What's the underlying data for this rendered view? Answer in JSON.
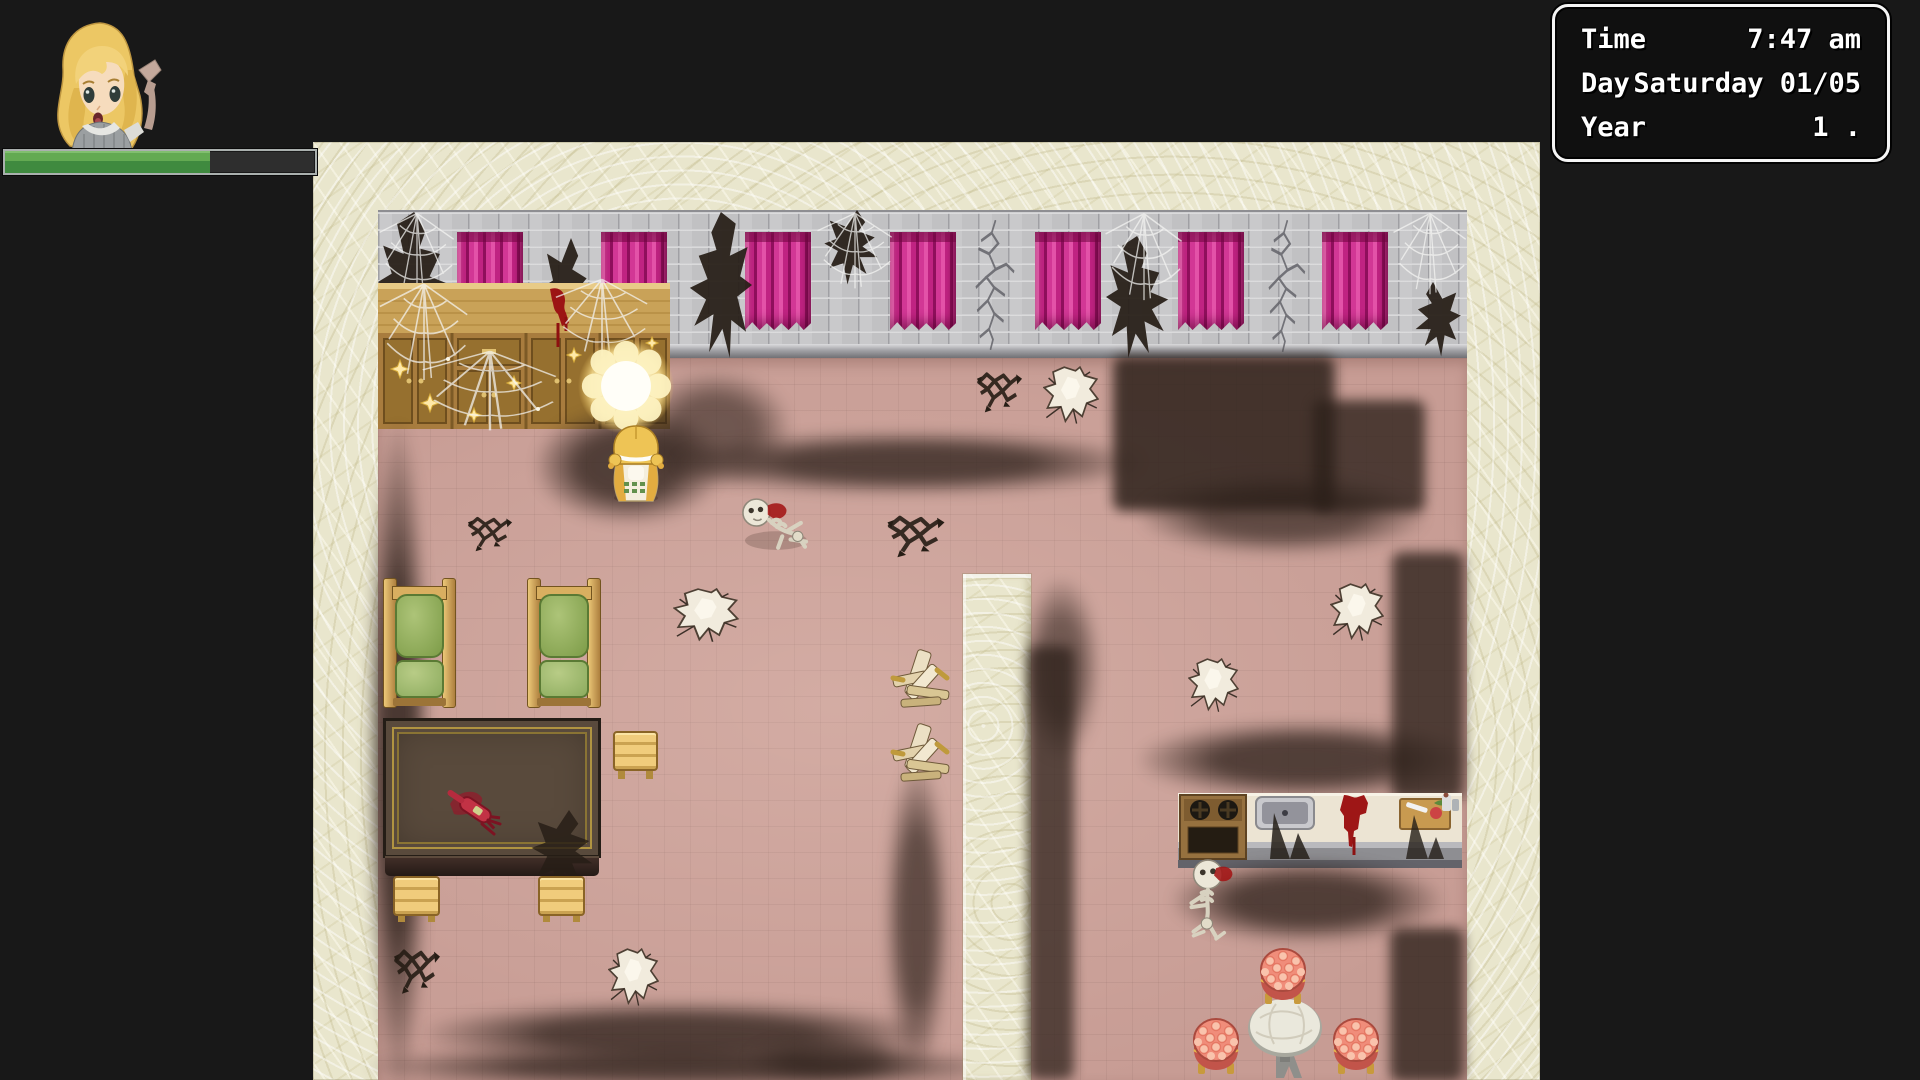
{
  "clock": {
    "rows": [
      {
        "label": "Time",
        "value": "7:47 am"
      },
      {
        "label": "Day",
        "value": "Saturday 01/05"
      },
      {
        "label": "Year",
        "value": "1 ."
      }
    ]
  },
  "hud": {
    "hp_bar": {
      "percent": 66,
      "fill_color": "#4c9a44",
      "track_color": "#2e2e2e",
      "frame_color": "#aab0ae"
    }
  },
  "colors": {
    "background": "#181818",
    "wallpaper": "#e9e6cd",
    "floor": "#c79c94",
    "brick_wall": "#c9c9cb",
    "curtain_magenta": "#c02382",
    "soot": "#2d211a",
    "blood": "#9e1616",
    "cushion_green": "#7d9c48",
    "wood_tan": "#c9a258"
  },
  "map": {
    "objects": [
      {
        "t": "curtain",
        "n": "curtain-1",
        "i": false,
        "x": 79,
        "y": 22,
        "w": 66,
        "h": 98
      },
      {
        "t": "curtain",
        "n": "curtain-2",
        "i": false,
        "x": 223,
        "y": 22,
        "w": 66,
        "h": 98
      },
      {
        "t": "curtain",
        "n": "curtain-3",
        "i": false,
        "x": 367,
        "y": 22,
        "w": 66,
        "h": 98
      },
      {
        "t": "curtain",
        "n": "curtain-4",
        "i": false,
        "x": 512,
        "y": 22,
        "w": 66,
        "h": 98
      },
      {
        "t": "curtain",
        "n": "curtain-5",
        "i": false,
        "x": 657,
        "y": 22,
        "w": 66,
        "h": 98
      },
      {
        "t": "curtain",
        "n": "curtain-6",
        "i": false,
        "x": 800,
        "y": 22,
        "w": 66,
        "h": 98
      },
      {
        "t": "curtain",
        "n": "curtain-7",
        "i": false,
        "x": 944,
        "y": 22,
        "w": 66,
        "h": 98
      },
      {
        "t": "torn",
        "n": "wall-hole-1",
        "i": false,
        "x": 0,
        "y": 2,
        "w": 86,
        "h": 140,
        "v": 1
      },
      {
        "t": "torn",
        "n": "wall-hole-2",
        "i": false,
        "x": 163,
        "y": 28,
        "w": 60,
        "h": 112,
        "v": 2
      },
      {
        "t": "torn",
        "n": "wall-hole-3",
        "i": false,
        "x": 300,
        "y": 2,
        "w": 74,
        "h": 146,
        "v": 1,
        "tr": "scaleX(-1)"
      },
      {
        "t": "torn",
        "n": "wall-hole-4",
        "i": false,
        "x": 445,
        "y": 0,
        "w": 68,
        "h": 76,
        "v": 2
      },
      {
        "t": "torn",
        "n": "wall-hole-5",
        "i": false,
        "x": 728,
        "y": 26,
        "w": 74,
        "h": 122,
        "v": 1
      },
      {
        "t": "torn",
        "n": "wall-hole-6",
        "i": false,
        "x": 1026,
        "y": 72,
        "w": 58,
        "h": 76,
        "v": 2,
        "tr": "scaleX(-1)"
      },
      {
        "t": "crackwall",
        "n": "wall-crack-1",
        "i": false,
        "x": 582,
        "y": 10,
        "w": 66,
        "h": 130
      },
      {
        "t": "crackwall",
        "n": "wall-crack-2",
        "i": false,
        "x": 876,
        "y": 10,
        "w": 62,
        "h": 132
      },
      {
        "t": "web",
        "n": "spider-web-1",
        "i": false,
        "x": 0,
        "y": 0,
        "w": 78,
        "h": 86
      },
      {
        "t": "web",
        "n": "spider-web-2",
        "i": false,
        "x": 438,
        "y": 0,
        "w": 78,
        "h": 80
      },
      {
        "t": "web",
        "n": "spider-web-3",
        "i": false,
        "x": 726,
        "y": 0,
        "w": 80,
        "h": 92
      },
      {
        "t": "web",
        "n": "spider-web-4",
        "i": false,
        "x": 1014,
        "y": 0,
        "w": 76,
        "h": 86
      },
      {
        "t": "cabinet",
        "n": "cabinet",
        "i": true,
        "x": 0,
        "y": 73,
        "w": 292,
        "h": 146
      },
      {
        "t": "web",
        "n": "spider-web-5",
        "i": false,
        "x": 0,
        "y": 70,
        "w": 92,
        "h": 102
      },
      {
        "t": "web",
        "n": "spider-web-6",
        "i": false,
        "x": 42,
        "y": 138,
        "w": 140,
        "h": 84
      },
      {
        "t": "web",
        "n": "spider-web-7",
        "i": false,
        "x": 176,
        "y": 66,
        "w": 96,
        "h": 82
      },
      {
        "t": "soot",
        "n": "floor-soot-1",
        "i": false,
        "x": -10,
        "y": 215,
        "w": 60,
        "h": 660,
        "o": 0.85
      },
      {
        "t": "soot",
        "n": "floor-soot-2",
        "i": false,
        "x": 158,
        "y": 198,
        "w": 185,
        "h": 115,
        "o": 0.8
      },
      {
        "t": "soot",
        "n": "floor-soot-3",
        "i": false,
        "x": 262,
        "y": 162,
        "w": 150,
        "h": 115,
        "o": 0.6
      },
      {
        "t": "soot",
        "n": "floor-soot-4",
        "i": false,
        "x": 298,
        "y": 222,
        "w": 465,
        "h": 62,
        "o": 0.8
      },
      {
        "t": "soot-hard",
        "n": "floor-soot-5",
        "i": false,
        "x": 735,
        "y": 146,
        "w": 222,
        "h": 155,
        "o": 0.92
      },
      {
        "t": "soot-hard",
        "n": "floor-soot-6",
        "i": false,
        "x": 935,
        "y": 190,
        "w": 112,
        "h": 112,
        "o": 0.85
      },
      {
        "t": "soot",
        "n": "floor-soot-7",
        "i": false,
        "x": 762,
        "y": 266,
        "w": 285,
        "h": 78,
        "o": 0.7
      },
      {
        "t": "soot",
        "n": "floor-soot-8",
        "i": false,
        "x": 762,
        "y": 512,
        "w": 330,
        "h": 76,
        "o": 0.8
      },
      {
        "t": "soot",
        "n": "floor-soot-9",
        "i": false,
        "x": 508,
        "y": 552,
        "w": 62,
        "h": 310,
        "o": 0.7
      },
      {
        "t": "soot-hard",
        "n": "floor-soot-10",
        "i": false,
        "x": 1014,
        "y": 342,
        "w": 72,
        "h": 248,
        "o": 0.85
      },
      {
        "t": "soot",
        "n": "floor-soot-11",
        "i": false,
        "x": 48,
        "y": 792,
        "w": 500,
        "h": 64,
        "o": 0.8
      },
      {
        "t": "soot",
        "n": "floor-soot-12",
        "i": false,
        "x": -10,
        "y": 836,
        "w": 640,
        "h": 42,
        "o": 0.8
      },
      {
        "t": "soot",
        "n": "floor-soot-13",
        "i": false,
        "x": 370,
        "y": 825,
        "w": 170,
        "h": 48,
        "o": 0.6
      },
      {
        "t": "hole",
        "n": "floor-hole-1",
        "i": false,
        "x": 665,
        "y": 156,
        "w": 56,
        "h": 60
      },
      {
        "t": "hole",
        "n": "floor-hole-2",
        "i": false,
        "x": 295,
        "y": 378,
        "w": 66,
        "h": 56
      },
      {
        "t": "hole",
        "n": "floor-hole-3",
        "i": false,
        "x": 952,
        "y": 373,
        "w": 54,
        "h": 60
      },
      {
        "t": "hole",
        "n": "floor-hole-4",
        "i": false,
        "x": 810,
        "y": 448,
        "w": 51,
        "h": 56
      },
      {
        "t": "hole",
        "n": "floor-hole-5",
        "i": false,
        "x": 230,
        "y": 738,
        "w": 51,
        "h": 60
      },
      {
        "t": "xcrack",
        "n": "floor-crack-1",
        "i": false,
        "x": 597,
        "y": 152,
        "w": 49,
        "h": 56
      },
      {
        "t": "xcrack",
        "n": "floor-crack-2",
        "i": false,
        "x": 507,
        "y": 295,
        "w": 62,
        "h": 58
      },
      {
        "t": "xcrack",
        "n": "floor-crack-3",
        "i": false,
        "x": 88,
        "y": 298,
        "w": 48,
        "h": 48
      },
      {
        "t": "xcrack",
        "n": "floor-crack-4",
        "i": false,
        "x": 14,
        "y": 728,
        "w": 50,
        "h": 62
      },
      {
        "t": "chair-green",
        "n": "green-chair-1",
        "i": true,
        "x": 5,
        "y": 368,
        "w": 73,
        "h": 128
      },
      {
        "t": "chair-green",
        "n": "green-chair-2",
        "i": true,
        "x": 149,
        "y": 368,
        "w": 74,
        "h": 128
      },
      {
        "t": "big-table",
        "n": "dining-table",
        "i": true,
        "x": 5,
        "y": 508,
        "w": 218,
        "h": 160
      },
      {
        "t": "torn",
        "n": "table-shadow",
        "i": false,
        "x": 152,
        "y": 600,
        "w": 78,
        "h": 86,
        "v": 2,
        "o": 0.88
      },
      {
        "t": "stool-wood",
        "n": "wood-stool-1",
        "i": true,
        "x": 235,
        "y": 521,
        "w": 45,
        "h": 48
      },
      {
        "t": "stool-wood",
        "n": "wood-stool-2",
        "i": true,
        "x": 15,
        "y": 666,
        "w": 47,
        "h": 46
      },
      {
        "t": "stool-wood",
        "n": "wood-stool-3",
        "i": true,
        "x": 160,
        "y": 666,
        "w": 47,
        "h": 46
      },
      {
        "t": "broken",
        "n": "broken-chair-1",
        "i": false,
        "x": 508,
        "y": 438,
        "w": 70,
        "h": 70
      },
      {
        "t": "broken",
        "n": "broken-chair-2",
        "i": false,
        "x": 508,
        "y": 512,
        "w": 70,
        "h": 70
      },
      {
        "t": "kitchen",
        "n": "kitchen-counter",
        "i": true,
        "x": 800,
        "y": 583,
        "w": 284,
        "h": 75
      },
      {
        "t": "soot",
        "n": "floor-soot-14",
        "i": false,
        "x": 795,
        "y": 650,
        "w": 268,
        "h": 82,
        "o": 0.8
      },
      {
        "t": "soot-hard",
        "n": "floor-soot-15",
        "i": false,
        "x": 1012,
        "y": 718,
        "w": 74,
        "h": 154,
        "o": 0.85
      },
      {
        "t": "skeleton2",
        "n": "skeleton-2",
        "i": true,
        "x": 795,
        "y": 648,
        "w": 80,
        "h": 88
      },
      {
        "t": "round-table",
        "n": "round-table",
        "i": true,
        "x": 868,
        "y": 788,
        "w": 78,
        "h": 84
      },
      {
        "t": "stool-floral",
        "n": "floral-stool-1",
        "i": true,
        "x": 880,
        "y": 736,
        "w": 50,
        "h": 60
      },
      {
        "t": "stool-floral",
        "n": "floral-stool-2",
        "i": true,
        "x": 813,
        "y": 806,
        "w": 50,
        "h": 60
      },
      {
        "t": "stool-floral",
        "n": "floral-stool-3",
        "i": true,
        "x": 953,
        "y": 806,
        "w": 50,
        "h": 60
      },
      {
        "t": "skeleton1",
        "n": "skeleton-1",
        "i": true,
        "x": 360,
        "y": 285,
        "w": 74,
        "h": 60
      },
      {
        "t": "glow",
        "n": "light-orb",
        "i": true,
        "x": 200,
        "y": 128,
        "w": 96,
        "h": 96
      },
      {
        "t": "girl",
        "n": "player-character",
        "i": true,
        "x": 226,
        "y": 214,
        "w": 64,
        "h": 78
      },
      {
        "t": "pillar",
        "n": "interior-pillar",
        "i": false,
        "x": 585,
        "y": 364,
        "w": 68,
        "h": 506
      },
      {
        "t": "soot-hard",
        "n": "pillar-shadow",
        "i": false,
        "x": 650,
        "y": 436,
        "w": 46,
        "h": 434,
        "o": 0.8
      },
      {
        "t": "soot",
        "n": "pillar-shadow-fuzz",
        "i": false,
        "x": 645,
        "y": 368,
        "w": 76,
        "h": 180,
        "o": 0.6
      }
    ]
  }
}
